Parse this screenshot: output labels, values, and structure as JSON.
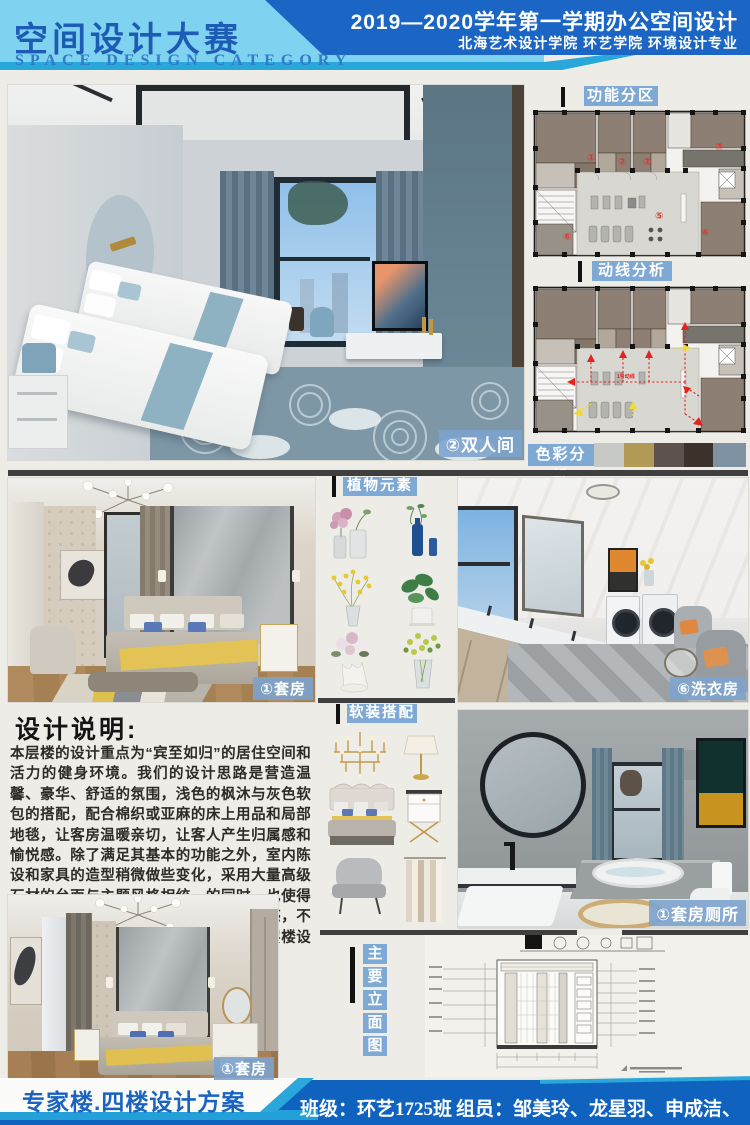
{
  "header": {
    "title_cn": "空间设计大赛",
    "title_en": "SPACE DESIGN CATEGORY",
    "term_line": "2019—2020学年第一学期办公空间设计",
    "school_line": "北海艺术设计学院  环艺学院  环境设计专业"
  },
  "section_titles": {
    "function_zoning": "功能分区",
    "circulation": "动线分析",
    "color_analysis": "色彩分析",
    "plants": "植物元素",
    "soft_furnishing": "软装搭配",
    "elevation": [
      "主",
      "要",
      "立",
      "面",
      "图"
    ]
  },
  "photo_labels": {
    "twin_room": "②双人间",
    "suite_mid": "①套房",
    "suite_bottom": "①套房",
    "laundry": "⑥洗衣房",
    "bathroom": "①套房厕所"
  },
  "floor_plan": {
    "room_numbers": [
      "①",
      "②",
      "②",
      "③",
      "④",
      "⑤",
      "⑥"
    ],
    "route_label": "1号动线"
  },
  "color_analysis": {
    "swatches": [
      "#c7c9c6",
      "#b19a55",
      "#5d524d",
      "#3c322c",
      "#7e92a3"
    ]
  },
  "design_note": {
    "title": "设计说明:",
    "body": "本层楼的设计重点为“宾至如归”的居住空间和活力的健身环境。我们的设计思路是营造温馨、豪华、舒适的氛围，浅色的枫沐与灰色软包的搭配，配合棉织或亚麻的床上用品和局部地毯，让客房温暖亲切，让客人产生归属感和愉悦感。除了满足其基本的功能之外，室内陈设和家具的造型稍微做些变化，采用大量高级石材的台面与主题风格相统一的同时，也使得客房的室内空间具有一种艺术感和厚重感，不至流落于传统俗套，显得低俗。另在本层楼设计了"
  },
  "footer": {
    "project": "专家楼.四楼设计方案",
    "class_info": "班级：环艺1725班",
    "members": "组员：邹美玲、龙星羽、申成洁、付成军"
  }
}
